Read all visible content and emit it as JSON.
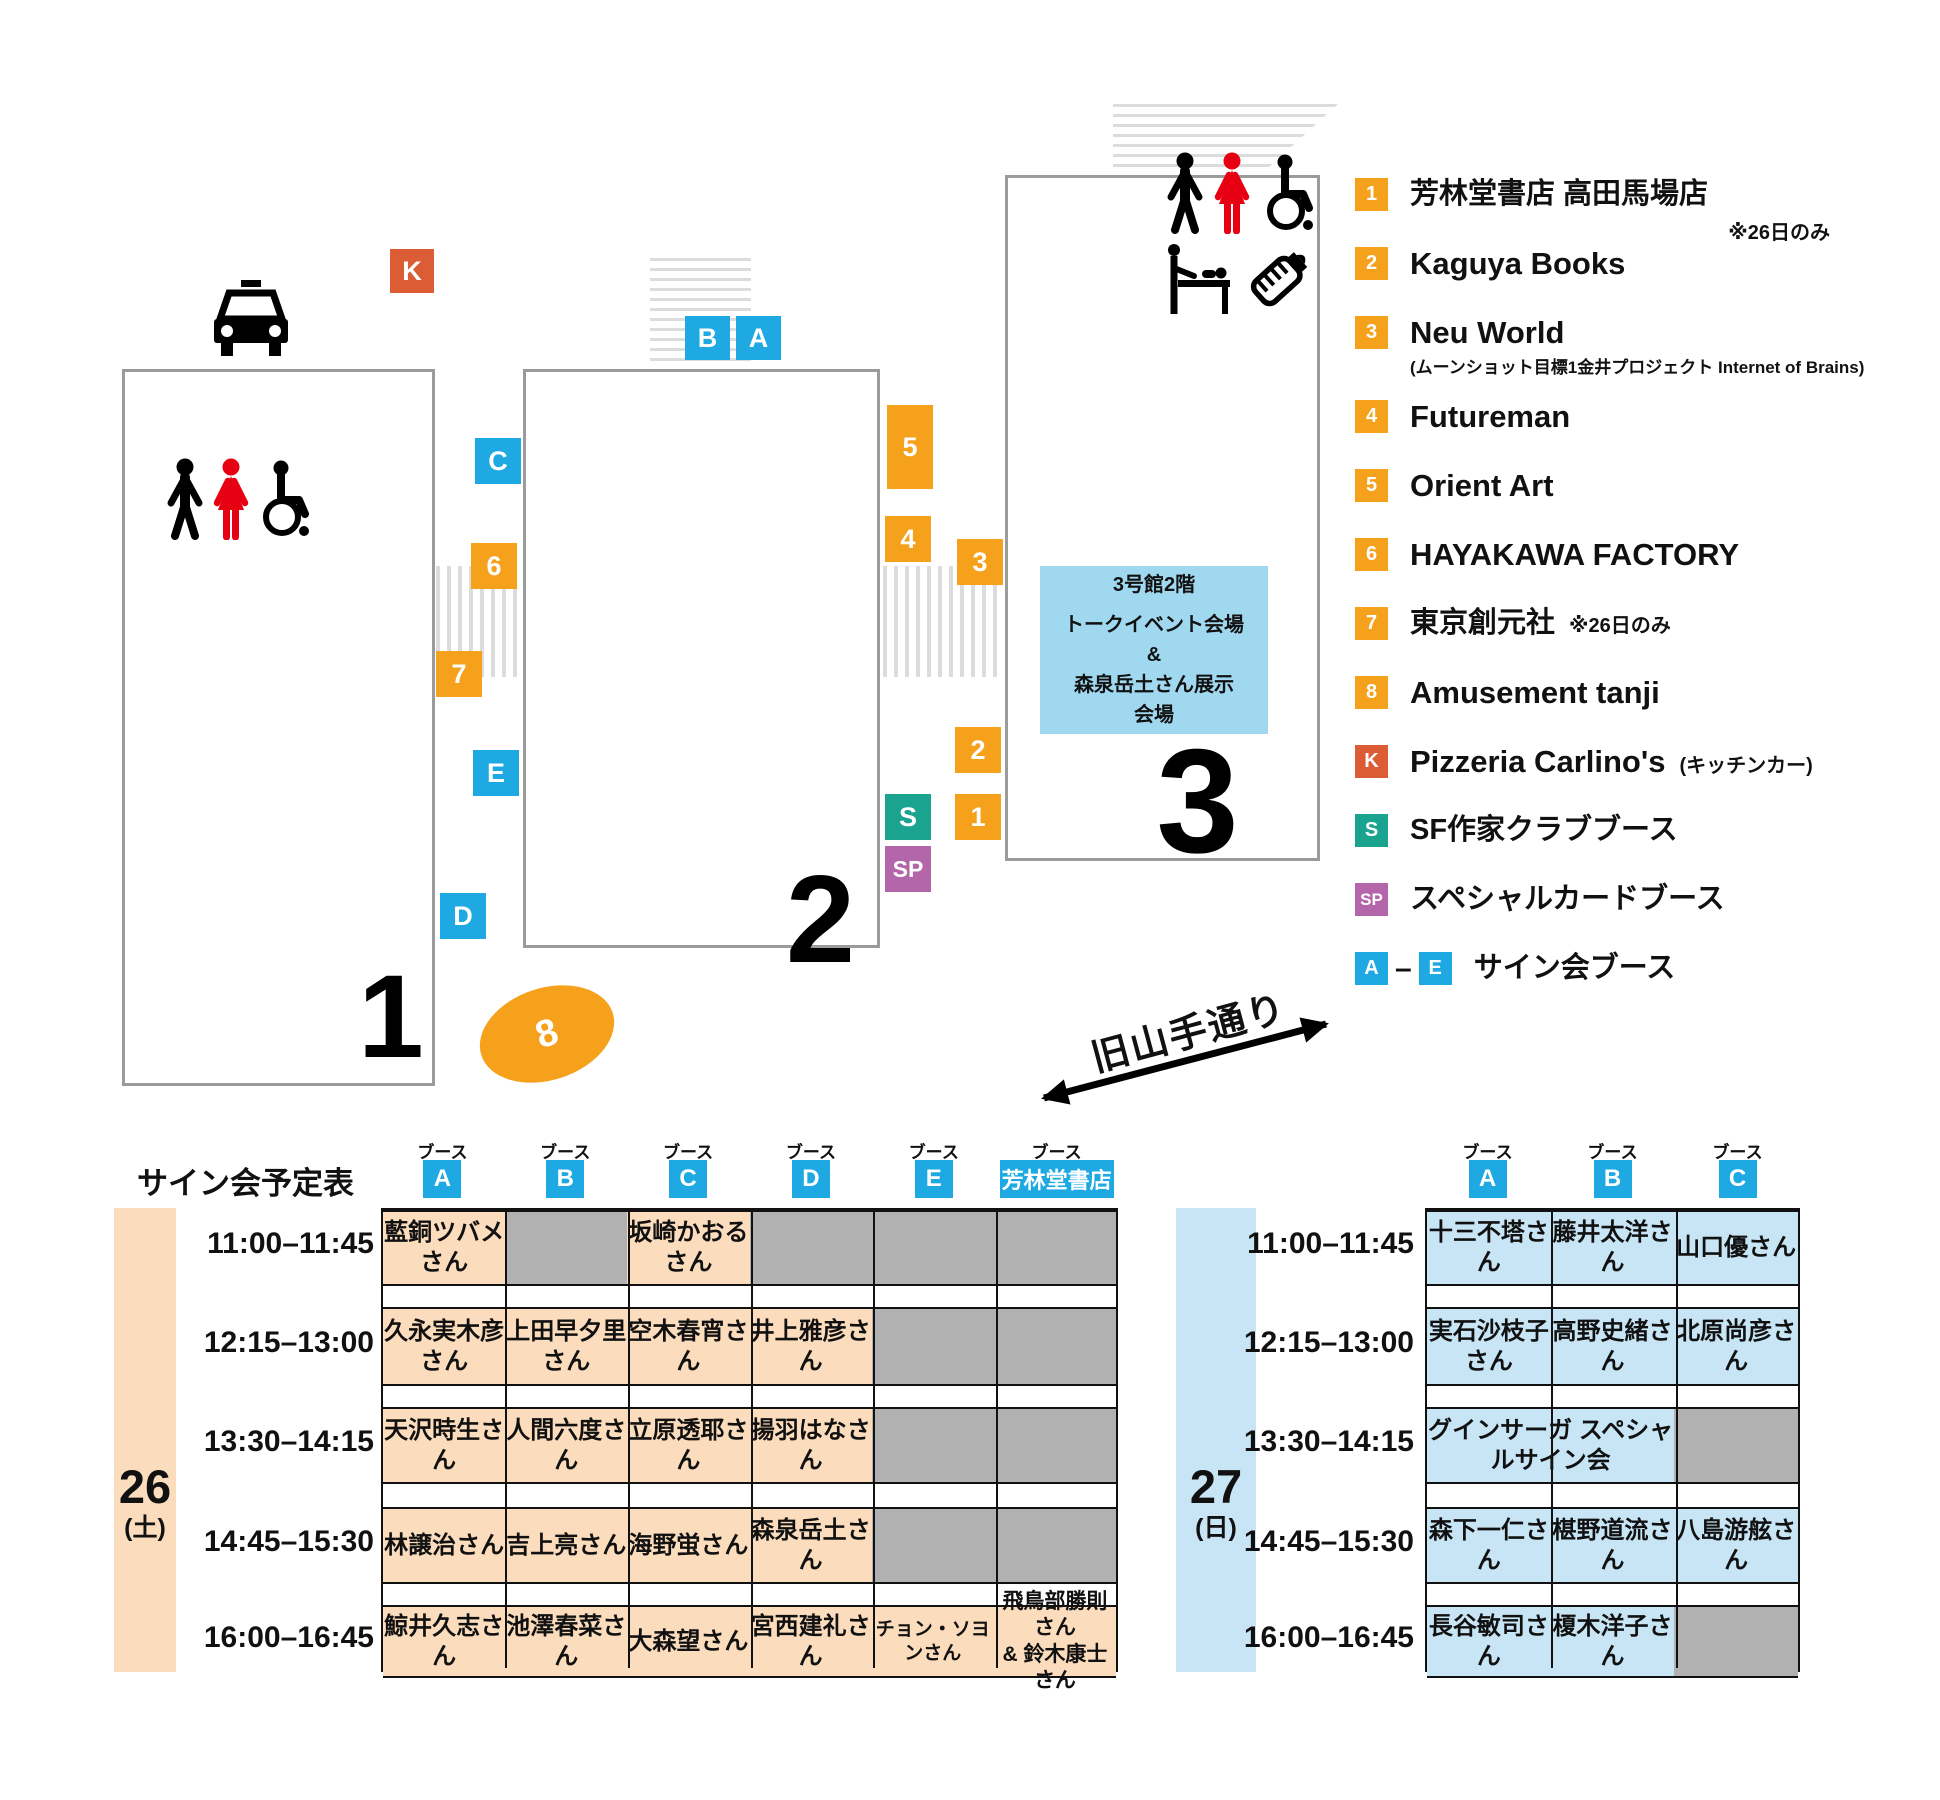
{
  "colors": {
    "orange": "#F5A11B",
    "red": "#DC5C35",
    "teal": "#1AA38E",
    "purple": "#B466AB",
    "blue": "#1FA9E2",
    "peach": "#FBDCBC",
    "gray": "#B1B1B1",
    "lightblue": "#C7E5F5",
    "infoblue": "#A0D8F0",
    "pictogram_red": "#E60012",
    "stripe": "#DCDCDC"
  },
  "map": {
    "buildings": [
      {
        "id": "1",
        "label": "1"
      },
      {
        "id": "2",
        "label": "2"
      },
      {
        "id": "3",
        "label": "3"
      }
    ],
    "booths": [
      {
        "id": "K",
        "label": "K",
        "color": "red"
      },
      {
        "id": "B",
        "label": "B",
        "color": "blue"
      },
      {
        "id": "A",
        "label": "A",
        "color": "blue"
      },
      {
        "id": "C",
        "label": "C",
        "color": "blue"
      },
      {
        "id": "6",
        "label": "6",
        "color": "orange"
      },
      {
        "id": "7",
        "label": "7",
        "color": "orange"
      },
      {
        "id": "E",
        "label": "E",
        "color": "blue"
      },
      {
        "id": "D",
        "label": "D",
        "color": "blue"
      },
      {
        "id": "5",
        "label": "5",
        "color": "orange"
      },
      {
        "id": "4",
        "label": "4",
        "color": "orange"
      },
      {
        "id": "3",
        "label": "3",
        "color": "orange"
      },
      {
        "id": "2",
        "label": "2",
        "color": "orange"
      },
      {
        "id": "1",
        "label": "1",
        "color": "orange"
      },
      {
        "id": "S",
        "label": "S",
        "color": "teal"
      },
      {
        "id": "SP",
        "label": "SP",
        "color": "purple"
      }
    ],
    "ellipse_booth": {
      "id": "8",
      "label": "8",
      "color": "orange"
    },
    "info_box": {
      "lines": [
        "3号館2階",
        "トークイベント会場",
        "&",
        "森泉岳土さん展示",
        "会場"
      ]
    },
    "road_label": "旧山手通り",
    "icons": [
      "taxi-icon",
      "restroom-men-icon",
      "restroom-women-icon",
      "wheelchair-icon",
      "baby-changing-icon",
      "nursing-bottle-icon",
      "road-arrow-icon"
    ]
  },
  "legend": {
    "dash": "–",
    "items": [
      {
        "key": "1",
        "color": "orange",
        "label": "芳林堂書店 高田馬場店",
        "note_below": "※26日のみ"
      },
      {
        "key": "2",
        "color": "orange",
        "label": "Kaguya Books",
        "latin": true
      },
      {
        "key": "3",
        "color": "orange",
        "label": "Neu World",
        "latin": true,
        "subtext": "(ムーンショット目標1金井プロジェクト Internet of Brains)"
      },
      {
        "key": "4",
        "color": "orange",
        "label": "Futureman",
        "latin": true
      },
      {
        "key": "5",
        "color": "orange",
        "label": "Orient Art",
        "latin": true
      },
      {
        "key": "6",
        "color": "orange",
        "label": "HAYAKAWA FACTORY",
        "latin": true
      },
      {
        "key": "7",
        "color": "orange",
        "label": "東京創元社",
        "note_inline": "※26日のみ"
      },
      {
        "key": "8",
        "color": "orange",
        "label": "Amusement tanji",
        "latin": true
      },
      {
        "key": "K",
        "color": "red",
        "label": "Pizzeria Carlino's",
        "latin": true,
        "note_inline": "(キッチンカー)"
      },
      {
        "key": "S",
        "color": "teal",
        "label": "SF作家クラブブース"
      },
      {
        "key": "SP",
        "color": "purple",
        "label": "スペシャルカードブース"
      },
      {
        "key": "A",
        "key2": "E",
        "color": "blue",
        "composite": true,
        "label": "サイン会ブース"
      }
    ]
  },
  "schedule": {
    "title": "サイン会予定表",
    "booth_header_label": "ブース",
    "tables": [
      {
        "id": "26",
        "day": "26",
        "day_note": "(土)",
        "band_color": "peach",
        "columns": [
          {
            "label": "A"
          },
          {
            "label": "B"
          },
          {
            "label": "C"
          },
          {
            "label": "D"
          },
          {
            "label": "E"
          },
          {
            "label": "芳林堂書店",
            "wide": true
          }
        ],
        "rows": [
          {
            "time": "11:00–11:45",
            "cells": [
              {
                "text": "藍銅ツバメさん",
                "bg": "peach"
              },
              {
                "bg": "gray"
              },
              {
                "text": "坂崎かおるさん",
                "bg": "peach"
              },
              {
                "bg": "gray"
              },
              {
                "bg": "gray"
              },
              {
                "bg": "gray"
              }
            ]
          },
          {
            "time": "12:15–13:00",
            "cells": [
              {
                "text": "久永実木彦さん",
                "bg": "peach"
              },
              {
                "text": "上田早夕里さん",
                "bg": "peach"
              },
              {
                "text": "空木春宵さん",
                "bg": "peach"
              },
              {
                "text": "井上雅彦さん",
                "bg": "peach"
              },
              {
                "bg": "gray"
              },
              {
                "bg": "gray"
              }
            ]
          },
          {
            "time": "13:30–14:15",
            "cells": [
              {
                "text": "天沢時生さん",
                "bg": "peach"
              },
              {
                "text": "人間六度さん",
                "bg": "peach"
              },
              {
                "text": "立原透耶さん",
                "bg": "peach"
              },
              {
                "text": "揚羽はなさん",
                "bg": "peach"
              },
              {
                "bg": "gray"
              },
              {
                "bg": "gray"
              }
            ]
          },
          {
            "time": "14:45–15:30",
            "cells": [
              {
                "text": "林譲治さん",
                "bg": "peach"
              },
              {
                "text": "吉上亮さん",
                "bg": "peach"
              },
              {
                "text": "海野蛍さん",
                "bg": "peach"
              },
              {
                "text": "森泉岳土さん",
                "bg": "peach"
              },
              {
                "bg": "gray"
              },
              {
                "bg": "gray"
              }
            ]
          },
          {
            "time": "16:00–16:45",
            "cells": [
              {
                "text": "鯨井久志さん",
                "bg": "peach"
              },
              {
                "text": "池澤春菜さん",
                "bg": "peach"
              },
              {
                "text": "大森望さん",
                "bg": "peach"
              },
              {
                "text": "宮西建礼さん",
                "bg": "peach"
              },
              {
                "text": "チョン・ソヨンさん",
                "bg": "peach",
                "size": "small"
              },
              {
                "text": "飛鳥部勝則さん\n& 鈴木康士さん",
                "bg": "peach",
                "size": "two"
              }
            ]
          }
        ]
      },
      {
        "id": "27",
        "day": "27",
        "day_note": "(日)",
        "band_color": "lightblue",
        "columns": [
          {
            "label": "A"
          },
          {
            "label": "B"
          },
          {
            "label": "C"
          }
        ],
        "rows": [
          {
            "time": "11:00–11:45",
            "cells": [
              {
                "text": "十三不塔さん",
                "bg": "lightblue"
              },
              {
                "text": "藤井太洋さん",
                "bg": "lightblue"
              },
              {
                "text": "山口優さん",
                "bg": "lightblue"
              }
            ]
          },
          {
            "time": "12:15–13:00",
            "cells": [
              {
                "text": "実石沙枝子さん",
                "bg": "lightblue"
              },
              {
                "text": "高野史緒さん",
                "bg": "lightblue"
              },
              {
                "text": "北原尚彦さん",
                "bg": "lightblue"
              }
            ]
          },
          {
            "time": "13:30–14:15",
            "cells": [
              {
                "text": "グインサーガ スペシャルサイン会",
                "bg": "lightblue",
                "span": 2
              },
              {
                "bg": "gray"
              }
            ]
          },
          {
            "time": "14:45–15:30",
            "cells": [
              {
                "text": "森下一仁さん",
                "bg": "lightblue"
              },
              {
                "text": "椹野道流さん",
                "bg": "lightblue"
              },
              {
                "text": "八島游舷さん",
                "bg": "lightblue"
              }
            ]
          },
          {
            "time": "16:00–16:45",
            "cells": [
              {
                "text": "長谷敏司さん",
                "bg": "lightblue"
              },
              {
                "text": "榎木洋子さん",
                "bg": "lightblue"
              },
              {
                "bg": "gray"
              }
            ]
          }
        ]
      }
    ]
  }
}
